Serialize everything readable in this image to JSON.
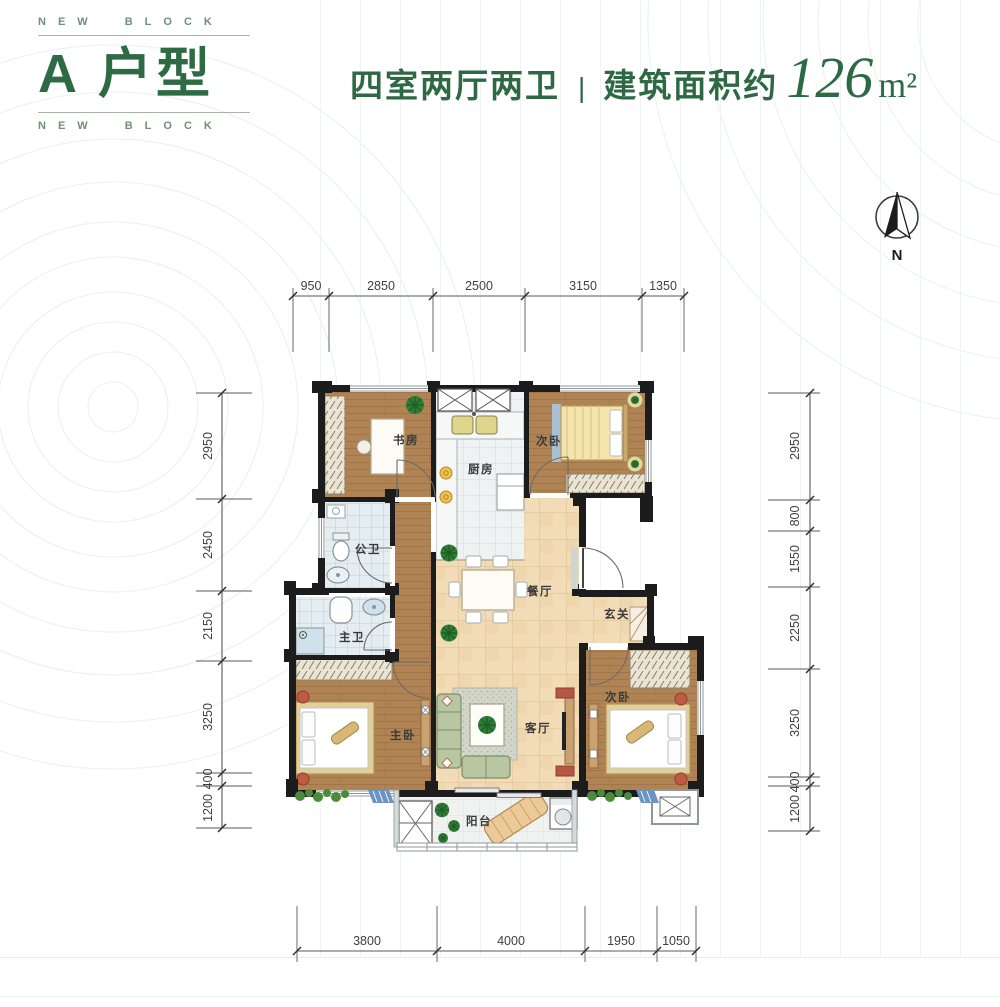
{
  "header": {
    "brand_top": "NEW BLOCK",
    "brand_bottom": "NEW BLOCK",
    "unit_title": "A 户型",
    "layout_text": "四室两厅两卫",
    "divider": "|",
    "area_label": "建筑面积约",
    "area_value": "126",
    "area_unit": "m²",
    "accent_color": "#2E6B45"
  },
  "compass": {
    "north_label": "N"
  },
  "rooms": {
    "study": "书房",
    "kitchen": "厨房",
    "bedroom_top": "次卧",
    "bath_public": "公卫",
    "bath_master": "主卫",
    "dining": "餐厅",
    "entry": "玄关",
    "master": "主卧",
    "living": "客厅",
    "bedroom_right": "次卧",
    "balcony": "阳台"
  },
  "dimensions": {
    "top": [
      "950",
      "2850",
      "2500",
      "3150",
      "1350"
    ],
    "left": [
      "2950",
      "2450",
      "2150",
      "3250",
      "400",
      "1200"
    ],
    "right": [
      "2950",
      "800",
      "1550",
      "2250",
      "3250",
      "400",
      "1200"
    ],
    "bottom": [
      "3800",
      "4000",
      "1950",
      "1050"
    ]
  },
  "colors": {
    "wall": "#1c1c1c",
    "wood_floor": "#b08354",
    "bath_tile": "#e4edf1",
    "warm_tile": "#f2dcb8",
    "accent_green": "#2E6B45"
  }
}
